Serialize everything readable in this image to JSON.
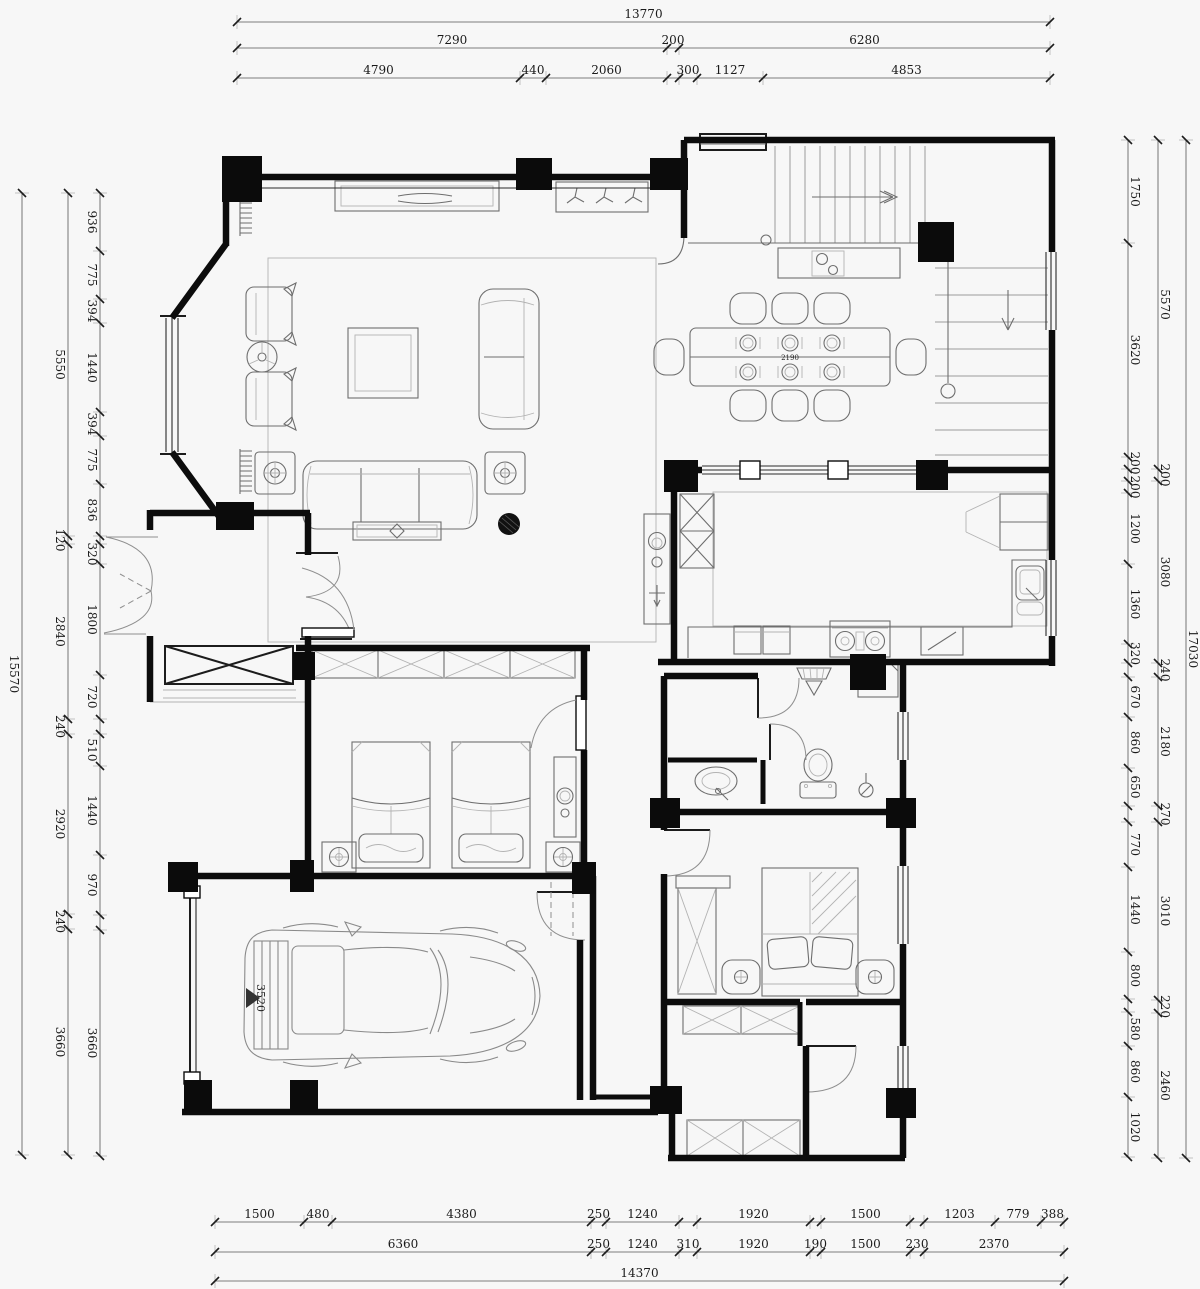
{
  "plan_labels": [
    {
      "id": "car-length-label",
      "text": "3520",
      "x": 257,
      "y": 998,
      "rotate": 90,
      "size": 11
    },
    {
      "id": "dining-table-size-label",
      "text": "2190",
      "x": 790,
      "y": 360,
      "rotate": 0,
      "size": 7
    }
  ],
  "dim_chains": [
    {
      "id": "top-overall",
      "dir": "h",
      "line": 22,
      "start": 237,
      "side": -1,
      "segments": [
        {
          "label": "13770",
          "px": 813
        }
      ]
    },
    {
      "id": "top-middle",
      "dir": "h",
      "line": 48,
      "start": 237,
      "side": -1,
      "segments": [
        {
          "label": "7290",
          "px": 430
        },
        {
          "label": "200",
          "px": 12
        },
        {
          "label": "6280",
          "px": 371
        }
      ]
    },
    {
      "id": "top-inner",
      "dir": "h",
      "line": 78,
      "start": 237,
      "side": -1,
      "segments": [
        {
          "label": "4790",
          "px": 283
        },
        {
          "label": "440",
          "px": 26
        },
        {
          "label": "2060",
          "px": 121
        },
        {
          "label": "",
          "px": 12
        },
        {
          "label": "300",
          "px": 18
        },
        {
          "label": "1127",
          "px": 66
        },
        {
          "label": "4853",
          "px": 287
        }
      ]
    },
    {
      "id": "left-outer",
      "dir": "v",
      "line": 22,
      "start": 193,
      "side": -1,
      "segments": [
        {
          "label": "15570",
          "px": 962
        }
      ]
    },
    {
      "id": "left-middle",
      "dir": "v",
      "line": 68,
      "start": 193,
      "side": -1,
      "segments": [
        {
          "label": "5550",
          "px": 343
        },
        {
          "label": "120",
          "px": 8
        },
        {
          "label": "2840",
          "px": 175
        },
        {
          "label": "240",
          "px": 15
        },
        {
          "label": "2920",
          "px": 180
        },
        {
          "label": "240",
          "px": 15
        },
        {
          "label": "3660",
          "px": 226
        }
      ]
    },
    {
      "id": "left-inner",
      "dir": "v",
      "line": 100,
      "start": 193,
      "side": -1,
      "segments": [
        {
          "label": "936",
          "px": 58
        },
        {
          "label": "775",
          "px": 48
        },
        {
          "label": "394",
          "px": 24
        },
        {
          "label": "1440",
          "px": 89
        },
        {
          "label": "394",
          "px": 24
        },
        {
          "label": "775",
          "px": 48
        },
        {
          "label": "836",
          "px": 52
        },
        {
          "label": "",
          "px": 8
        },
        {
          "label": "320",
          "px": 20
        },
        {
          "label": "1800",
          "px": 111
        },
        {
          "label": "720",
          "px": 44
        },
        {
          "label": "",
          "px": 15
        },
        {
          "label": "510",
          "px": 32
        },
        {
          "label": "1440",
          "px": 89
        },
        {
          "label": "970",
          "px": 60
        },
        {
          "label": "",
          "px": 15
        },
        {
          "label": "3660",
          "px": 226
        }
      ]
    },
    {
      "id": "right-inner",
      "dir": "v",
      "line": 1128,
      "start": 140,
      "side": 1,
      "segments": [
        {
          "label": "1750",
          "px": 103
        },
        {
          "label": "3620",
          "px": 214
        },
        {
          "label": "200",
          "px": 12
        },
        {
          "label": "",
          "px": 12
        },
        {
          "label": "200",
          "px": 12
        },
        {
          "label": "1200",
          "px": 71
        },
        {
          "label": "1360",
          "px": 80
        },
        {
          "label": "320",
          "px": 19
        },
        {
          "label": "",
          "px": 14
        },
        {
          "label": "670",
          "px": 40
        },
        {
          "label": "860",
          "px": 51
        },
        {
          "label": "650",
          "px": 38
        },
        {
          "label": "",
          "px": 16
        },
        {
          "label": "770",
          "px": 45
        },
        {
          "label": "1440",
          "px": 85
        },
        {
          "label": "800",
          "px": 47
        },
        {
          "label": "",
          "px": 13
        },
        {
          "label": "580",
          "px": 34
        },
        {
          "label": "860",
          "px": 51
        },
        {
          "label": "1020",
          "px": 60
        }
      ]
    },
    {
      "id": "right-middle",
      "dir": "v",
      "line": 1158,
      "start": 140,
      "side": 1,
      "segments": [
        {
          "label": "5570",
          "px": 329
        },
        {
          "label": "200",
          "px": 12
        },
        {
          "label": "3080",
          "px": 182
        },
        {
          "label": "240",
          "px": 14
        },
        {
          "label": "2180",
          "px": 129
        },
        {
          "label": "270",
          "px": 16
        },
        {
          "label": "3010",
          "px": 178
        },
        {
          "label": "220",
          "px": 13
        },
        {
          "label": "2460",
          "px": 145
        }
      ]
    },
    {
      "id": "right-outer",
      "dir": "v",
      "line": 1186,
      "start": 140,
      "side": 1,
      "segments": [
        {
          "label": "17030",
          "px": 1018
        }
      ]
    },
    {
      "id": "bottom-inner",
      "dir": "h",
      "line": 1222,
      "start": 215,
      "side": -1,
      "segments": [
        {
          "label": "1500",
          "px": 89
        },
        {
          "label": "480",
          "px": 28
        },
        {
          "label": "4380",
          "px": 259
        },
        {
          "label": "250",
          "px": 15
        },
        {
          "label": "1240",
          "px": 73
        },
        {
          "label": "",
          "px": 18
        },
        {
          "label": "1920",
          "px": 113
        },
        {
          "label": "",
          "px": 11
        },
        {
          "label": "1500",
          "px": 89
        },
        {
          "label": "",
          "px": 14
        },
        {
          "label": "1203",
          "px": 71
        },
        {
          "label": "779",
          "px": 46
        },
        {
          "label": "388",
          "px": 23
        }
      ]
    },
    {
      "id": "bottom-middle",
      "dir": "h",
      "line": 1252,
      "start": 215,
      "side": -1,
      "segments": [
        {
          "label": "6360",
          "px": 376
        },
        {
          "label": "250",
          "px": 15
        },
        {
          "label": "1240",
          "px": 73
        },
        {
          "label": "310",
          "px": 18
        },
        {
          "label": "1920",
          "px": 113
        },
        {
          "label": "190",
          "px": 11
        },
        {
          "label": "1500",
          "px": 89
        },
        {
          "label": "230",
          "px": 14
        },
        {
          "label": "2370",
          "px": 140
        }
      ]
    },
    {
      "id": "bottom-outer",
      "dir": "h",
      "line": 1281,
      "start": 215,
      "side": -1,
      "segments": [
        {
          "label": "14370",
          "px": 849
        }
      ]
    }
  ]
}
